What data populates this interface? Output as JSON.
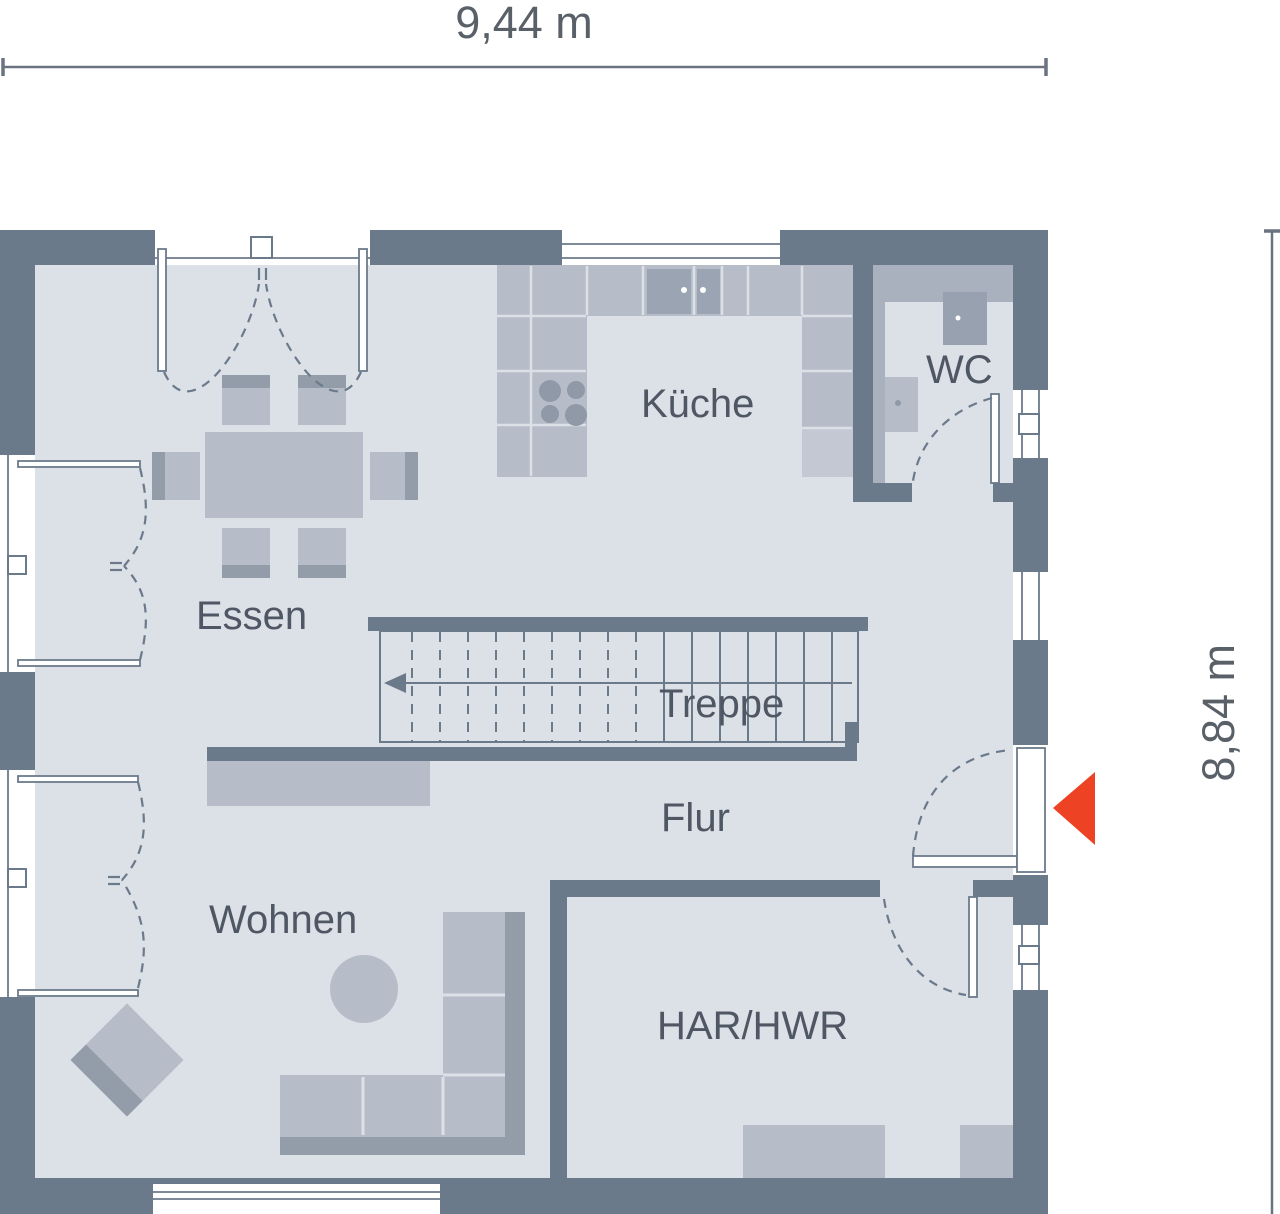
{
  "dimensions": {
    "width_label": "9,44 m",
    "height_label": "8,84 m"
  },
  "rooms": {
    "essen": {
      "label": "Essen"
    },
    "kueche": {
      "label": "Küche"
    },
    "wc": {
      "label": "WC"
    },
    "treppe": {
      "label": "Treppe"
    },
    "flur": {
      "label": "Flur"
    },
    "wohnen": {
      "label": "Wohnen"
    },
    "har": {
      "label": "HAR/HWR"
    }
  },
  "entrance_marker": {
    "icon": "entrance-arrow",
    "direction": "left",
    "color": "#ee4224"
  },
  "colors": {
    "wall": "#6b7a8b",
    "floor": "#dce0e7",
    "furniture": "#b7bdc8",
    "furniture_dark": "#939daa",
    "accent_red": "#ee4224",
    "text": "#4e5763",
    "dimension_text": "#596068"
  }
}
